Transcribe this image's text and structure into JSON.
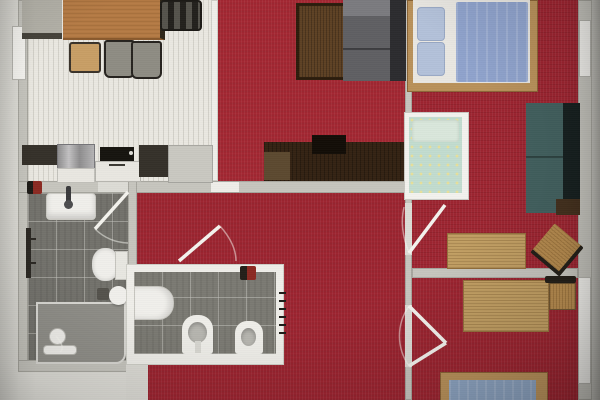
{
  "title": "Furnished apartment floor plan, top-down 3D render",
  "colors": {
    "carpet": "#9c2430",
    "carpetLiving": "#a32732",
    "kitchenFloor": "#eae8e1",
    "tile": "#73726c",
    "tileSmall": "#7b7a73",
    "wall": "#c6c5be",
    "wallLight": "#dcdbd5",
    "wallWhite": "#efeee9",
    "margin": "#d6d5cf",
    "outside": "#deddd7",
    "woodTable": "#b57b45",
    "woodDesk": "#c19e63",
    "woodFrame": "#b9915a",
    "woodDark": "#342313",
    "coffeeTable": "#5d4124",
    "sofaGray": "#5f5f63",
    "sofaGrayBack": "#2c2c2f",
    "sofaTeal": "#42605e",
    "sofaTealBack": "#16201f",
    "duvet": "#8fa3cc",
    "mattressBlue": "#8ba2bf",
    "pillowBlue": "#b3c1d9",
    "bedWhite": "#e9e7e2",
    "cribBedding": "#c2dccf",
    "cribDot": "#e7e09a",
    "white": "#f0efeb",
    "counterDark": "#35312a",
    "steel": "#a3a2a3",
    "applianceWhite": "#e9e7e1",
    "chairGray": "#8e8c83",
    "chairWood": "#c89e66",
    "frameDark": "#26231e",
    "accessoryRed": "#8b2a22",
    "binGray": "#54524c"
  },
  "rooms": [
    {
      "id": "kitchen-dining",
      "label": "Kitchen / dining room",
      "floor": "light striped"
    },
    {
      "id": "living-room",
      "label": "Living room",
      "floor": "red carpet"
    },
    {
      "id": "hallway",
      "label": "Hallway",
      "floor": "red carpet"
    },
    {
      "id": "bathroom-large",
      "label": "Bathroom with shower",
      "floor": "dark gray tiles"
    },
    {
      "id": "bathroom-small",
      "label": "Small bathroom / WC",
      "floor": "dark gray tiles"
    },
    {
      "id": "bedroom-1",
      "label": "Bedroom with double bed and crib",
      "floor": "red carpet"
    },
    {
      "id": "bedroom-2",
      "label": "Bedroom with single bed",
      "floor": "red carpet"
    }
  ],
  "furniture": [
    {
      "id": "sideboard",
      "room": "kitchen-dining",
      "label": "Sideboard"
    },
    {
      "id": "dining-table",
      "room": "kitchen-dining",
      "label": "Wooden dining table"
    },
    {
      "id": "dining-chair-wood",
      "room": "kitchen-dining",
      "label": "Wooden chair"
    },
    {
      "id": "dining-chair-gray-1",
      "room": "kitchen-dining",
      "label": "Upholstered chair"
    },
    {
      "id": "dining-chair-gray-2",
      "room": "kitchen-dining",
      "label": "Upholstered chair"
    },
    {
      "id": "dining-chair-head",
      "room": "kitchen-dining",
      "label": "Chair at table end"
    },
    {
      "id": "kitchen-counter",
      "room": "kitchen-dining",
      "label": "Kitchen counter"
    },
    {
      "id": "kitchen-sink",
      "room": "kitchen-dining",
      "label": "Kitchen sink"
    },
    {
      "id": "cooktop-oven",
      "room": "kitchen-dining",
      "label": "Cooktop and oven"
    },
    {
      "id": "coffee-table",
      "room": "living-room",
      "label": "Dark wood coffee table"
    },
    {
      "id": "sofa",
      "room": "living-room",
      "label": "Gray sofa"
    },
    {
      "id": "tv-sideboard",
      "room": "living-room",
      "label": "TV sideboard"
    },
    {
      "id": "wash-basin",
      "room": "bathroom-large",
      "label": "Wash basin"
    },
    {
      "id": "towel-rail",
      "room": "bathroom-large",
      "label": "Towel rail"
    },
    {
      "id": "shower",
      "room": "bathroom-large",
      "label": "Shower with tray"
    },
    {
      "id": "toilet-1",
      "room": "bathroom-large",
      "label": "Toilet"
    },
    {
      "id": "stool",
      "room": "bathroom-large",
      "label": "Round stool"
    },
    {
      "id": "waste-bin",
      "room": "bathroom-large",
      "label": "Waste bin"
    },
    {
      "id": "basin-small",
      "room": "bathroom-small",
      "label": "Basin"
    },
    {
      "id": "toilet-2",
      "room": "bathroom-small",
      "label": "Toilet"
    },
    {
      "id": "bidet",
      "room": "bathroom-small",
      "label": "Bidet"
    },
    {
      "id": "radiator",
      "room": "bathroom-small",
      "label": "Radiator symbol"
    },
    {
      "id": "double-bed",
      "room": "bedroom-1",
      "label": "Double bed with blue duvet"
    },
    {
      "id": "crib",
      "room": "bedroom-1",
      "label": "Baby crib"
    },
    {
      "id": "daybed",
      "room": "bedroom-1",
      "label": "Teal daybed"
    },
    {
      "id": "desk-1",
      "room": "bedroom-1",
      "label": "Desk"
    },
    {
      "id": "desk-chair-1",
      "room": "bedroom-1",
      "label": "Desk chair"
    },
    {
      "id": "side-shelf",
      "room": "bedroom-1",
      "label": "Side shelf"
    },
    {
      "id": "desk-2",
      "room": "bedroom-2",
      "label": "Desk"
    },
    {
      "id": "desk-chair-2",
      "room": "bedroom-2",
      "label": "Desk chair"
    },
    {
      "id": "single-bed",
      "room": "bedroom-2",
      "label": "Single bed with blue mattress"
    }
  ],
  "openings": [
    {
      "id": "door-bathroom-large",
      "label": "Door to large bathroom"
    },
    {
      "id": "door-bathroom-small",
      "label": "Door to small bathroom"
    },
    {
      "id": "door-bedroom-1",
      "label": "Door to bedroom 1"
    },
    {
      "id": "door-bedroom-2",
      "label": "Door to bedroom 2"
    },
    {
      "id": "passage-living-hall",
      "label": "Opening living room to hallway"
    },
    {
      "id": "window-left",
      "label": "Window, left wall"
    },
    {
      "id": "window-right-top",
      "label": "Window, right wall top"
    },
    {
      "id": "window-right-bottom",
      "label": "Window, right wall bottom"
    }
  ]
}
